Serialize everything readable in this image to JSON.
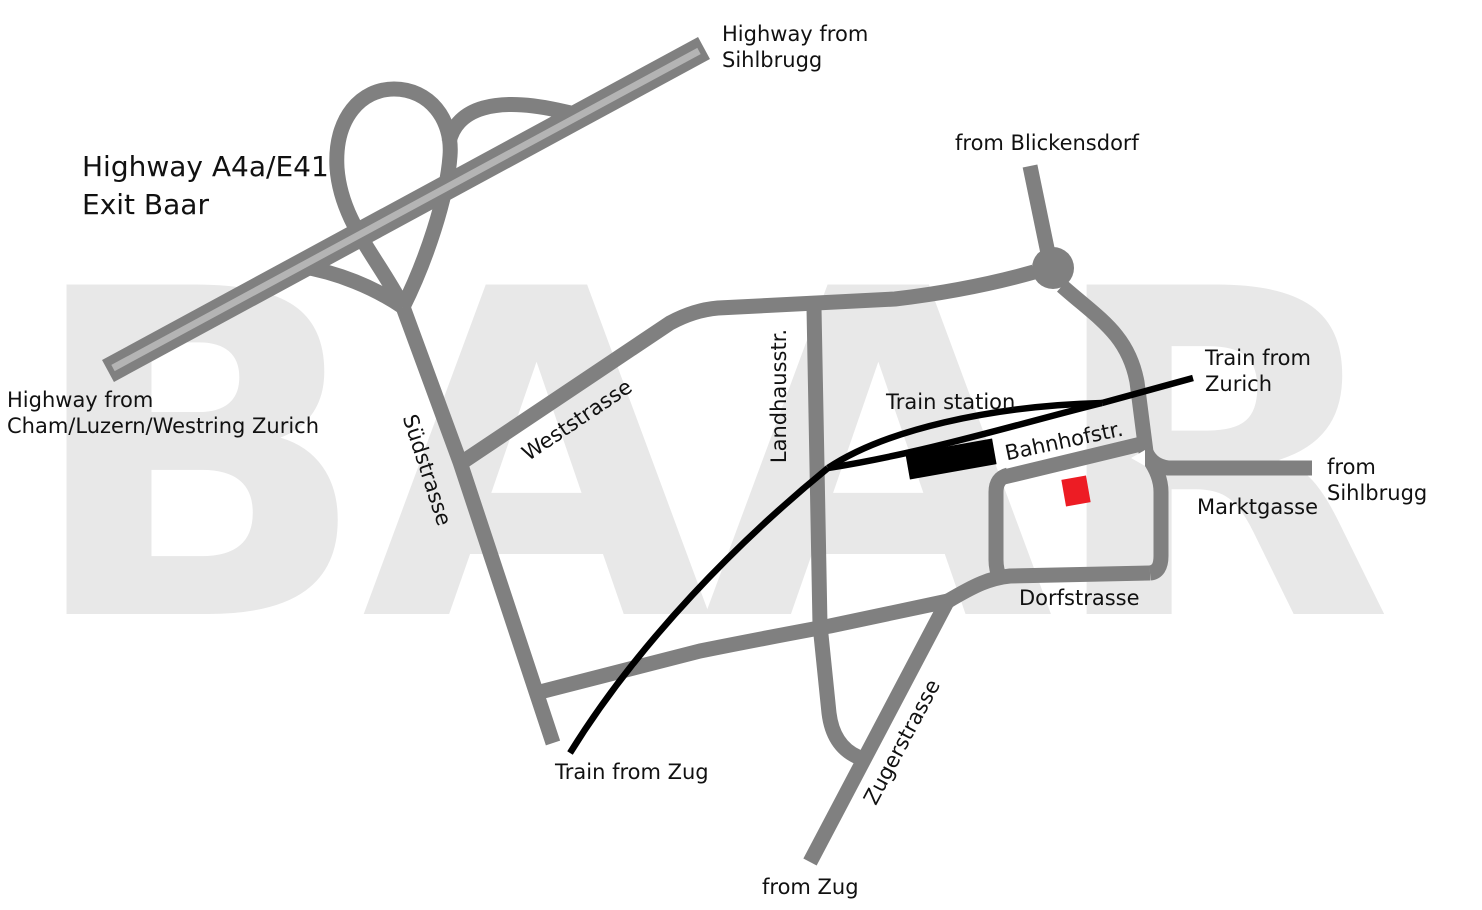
{
  "watermark": "BAAR",
  "colors": {
    "road": "#808080",
    "highway_stripe": "#b4b4b4",
    "railway": "#000000",
    "station_building": "#000000",
    "destination": "#ed1c24",
    "watermark": "#e8e8e8",
    "label_text": "#111111",
    "background": "#ffffff"
  },
  "labels": {
    "highway_from_sihlbrugg": "Highway from\nSihlbrugg",
    "highway_exit": "Highway A4a/E41\nExit Baar",
    "highway_from_cham": "Highway from\nCham/Luzern/Westring Zurich",
    "from_blickensdorf": "from Blickensdorf",
    "suedstrasse": "Südstrasse",
    "weststrasse": "Weststrasse",
    "landhausstrasse": "Landhausstr.",
    "train_station": "Train station",
    "bahnhofstrasse": "Bahnhofstr.",
    "train_from_zurich": "Train from\nZurich",
    "from_sihlbrugg": "from Sihlbrugg",
    "marktgasse": "Marktgasse",
    "dorfstrasse": "Dorfstrasse",
    "zugerstrasse": "Zugerstrasse",
    "from_zug": "from Zug",
    "train_from_zug": "Train from Zug"
  }
}
